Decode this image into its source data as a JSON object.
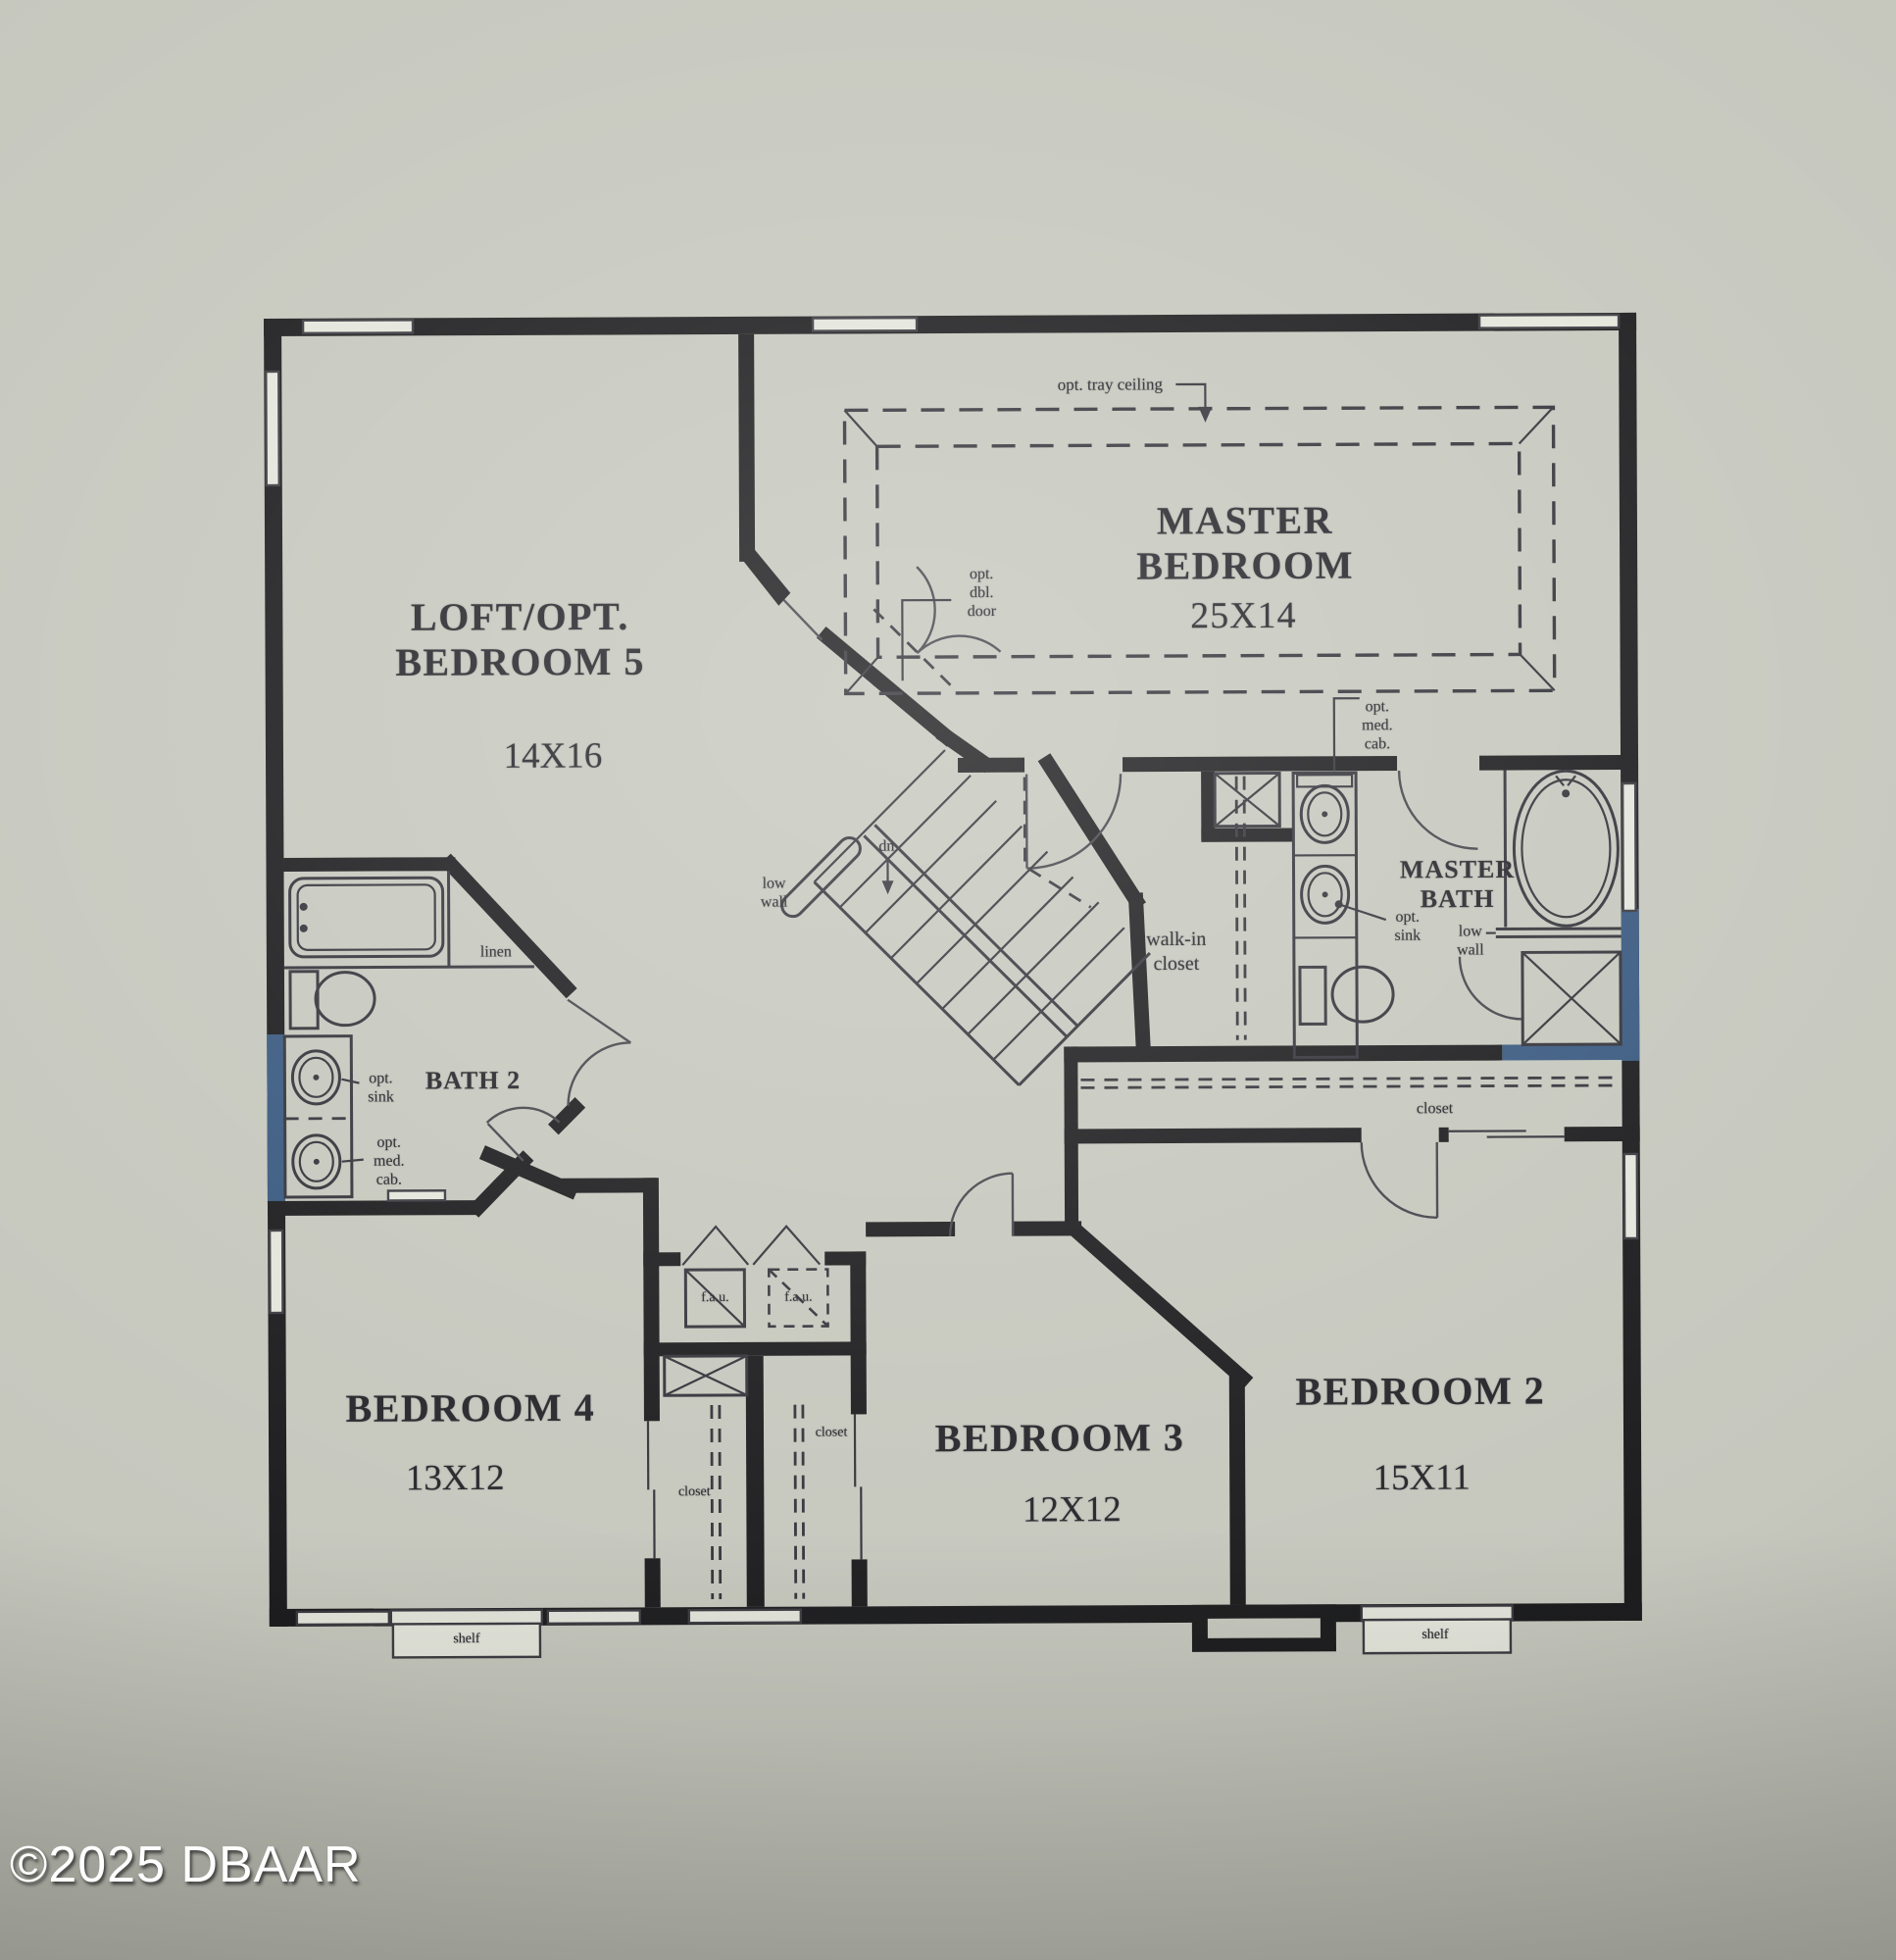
{
  "watermark": "©2025 DBAAR",
  "plan": {
    "title": "Second floor plan",
    "rooms": {
      "loft": {
        "name": "LOFT/OPT.\nBEDROOM 5",
        "dim": "14X16"
      },
      "master_bedroom": {
        "name": "MASTER\nBEDROOM",
        "dim": "25X14"
      },
      "master_bath": {
        "name": "MASTER\nBATH"
      },
      "bath2": {
        "name": "BATH 2"
      },
      "walk_in_closet": {
        "name": "walk-in\ncloset"
      },
      "bedroom2": {
        "name": "BEDROOM 2",
        "dim": "15X11"
      },
      "bedroom3": {
        "name": "BEDROOM 3",
        "dim": "12X12"
      },
      "bedroom4": {
        "name": "BEDROOM 4",
        "dim": "13X12"
      }
    },
    "annotations": {
      "tray_ceiling": "opt. tray ceiling",
      "dbl_door": "opt.\ndbl.\ndoor",
      "med_cab_master": "opt.\nmed.\ncab.",
      "opt_sink_master": "opt.\nsink",
      "low_wall_master": "low\nwall",
      "low_wall_stairs": "low\nwall",
      "stairs_dn": "dn",
      "linen": "linen",
      "opt_sink_bath2": "opt.\nsink",
      "med_cab_bath2": "opt.\nmed.\ncab.",
      "closet_master": "closet",
      "closet_bedroom4": "closet",
      "closet_bedroom3": "closet",
      "fau_1": "f.a.u.",
      "fau_2": "f.a.u.",
      "shelf_bedroom4": "shelf",
      "shelf_bedroom2": "shelf"
    }
  },
  "colors": {
    "paper": "#c6c8be",
    "paper2": "#cdcfc5",
    "win": "#e4e6dc",
    "ink": "#1d1d1f",
    "ink2": "#34343b",
    "blue": "#3a5a80",
    "text": "#26262b",
    "wm": "#ffffff"
  }
}
